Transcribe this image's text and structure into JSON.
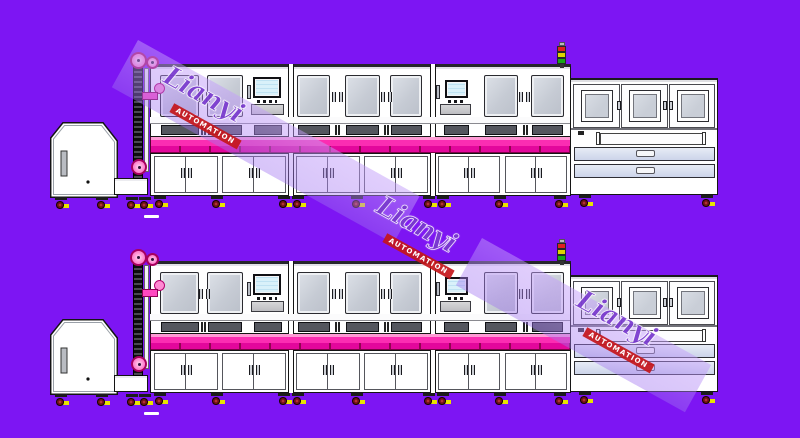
{
  "meta": {
    "description": "Engineering side-view drawing of an automated production line, duplicated in two rows on a purple background"
  },
  "watermark": {
    "brand": "Lianyi",
    "tagline": "AUTOMATION",
    "brand_color": "rgba(100,28,198,0.8)",
    "banner_color": "#c4161a",
    "band_color": "rgba(165,120,242,0.45)",
    "instances": 3
  },
  "drawing": {
    "rows": 2,
    "row_names": [
      "production-line-top",
      "production-line-bottom"
    ],
    "components": [
      "hopper-feeder",
      "outfeed-table",
      "chain-elevator",
      "process-module-1",
      "process-module-2",
      "process-module-3",
      "signal-tower",
      "unloading-station"
    ],
    "colors": {
      "background": "#7d15f3",
      "machine_body": "#ffffff",
      "outline": "#141414",
      "window_glass": "#c6cbd4",
      "conveyor_highlight": "#ff9ad5",
      "conveyor_pink_upper": "#fb2db2",
      "conveyor_pink_lower": "#e3079c",
      "drawer_fill": "#ccd4ea",
      "pulley_pink": "#ff85d0",
      "signal_red": "#e02020",
      "signal_yellow": "#ddd300",
      "signal_green": "#18a818",
      "caster_wheel_red": "#8a1016",
      "caster_foot_yellow": "#e8e400"
    }
  }
}
